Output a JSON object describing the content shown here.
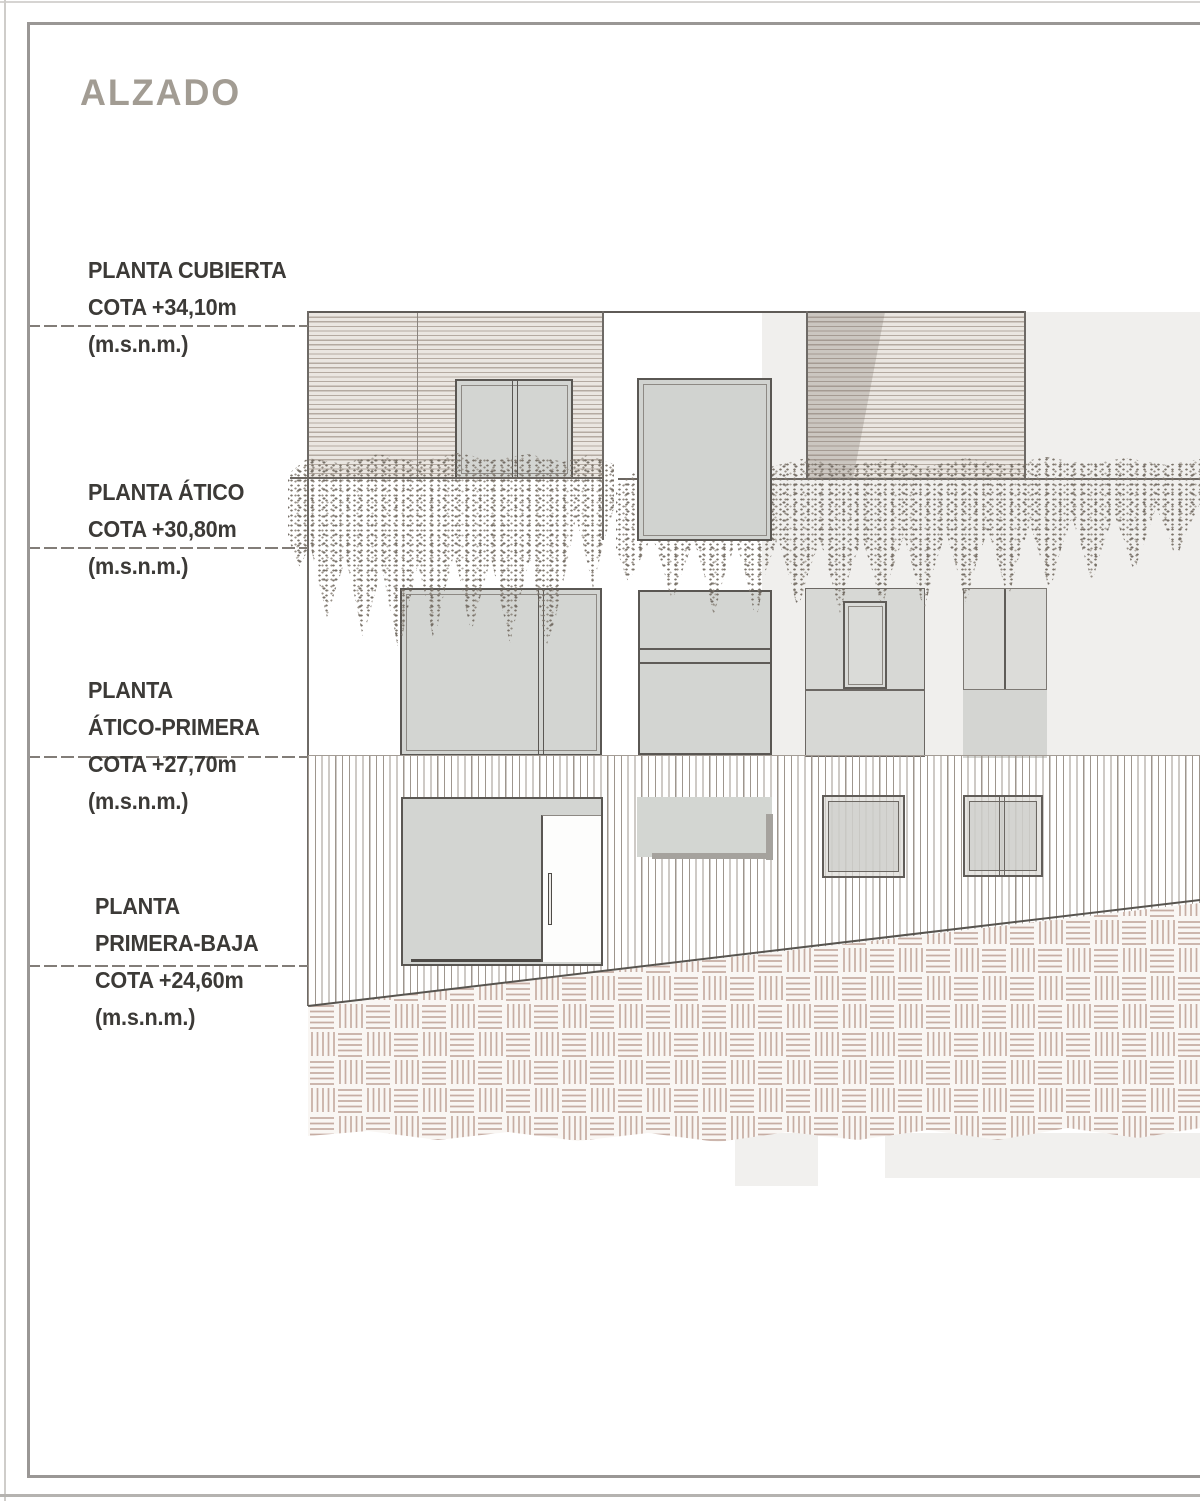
{
  "title": "ALZADO",
  "drawing_type_label": "ALZADO",
  "levels": [
    {
      "line1": "PLANTA CUBIERTA",
      "cota": "COTA +34,10m",
      "unit": "(m.s.n.m.)"
    },
    {
      "line1": "PLANTA ÁTICO",
      "cota": "COTA +30,80m",
      "unit": "(m.s.n.m.)"
    },
    {
      "line1": "PLANTA",
      "line2": "ÁTICO-PRIMERA",
      "cota": "COTA +27,70m",
      "unit": "(m.s.n.m.)"
    },
    {
      "line1": "PLANTA",
      "line2": "PRIMERA-BAJA",
      "cota": "COTA +24,60m",
      "unit": "(m.s.n.m.)"
    }
  ],
  "colors": {
    "title_text": "#a29c93",
    "label_text": "#3c3a37",
    "level_line": "#827d78",
    "roof_hatch_bg": "#eae6e1",
    "roof_hatch_line": "#b4aaa1",
    "wall_hatch_line": "#9e968e",
    "paving_line": "#c6ada3",
    "window_fill": "#d3d5d2",
    "window_frame": "#5a5753",
    "vegetation": "#877f75",
    "backdrop": "#f0efed",
    "ground_line": "#57544f"
  }
}
